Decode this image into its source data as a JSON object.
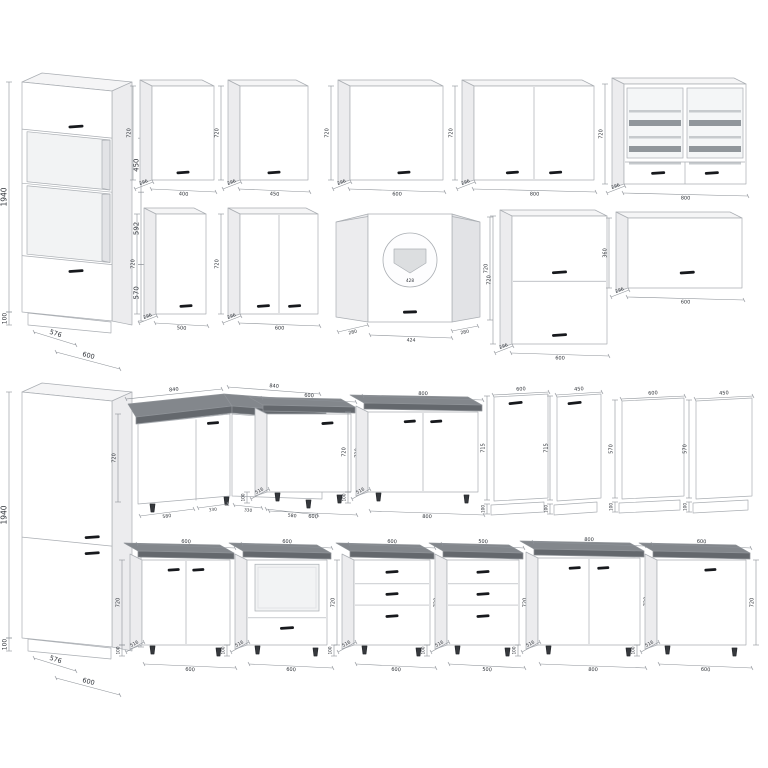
{
  "page": {
    "background": "#ffffff",
    "description": "kitchen cabinet set dimension drawings"
  },
  "colors": {
    "cabinet": "#ffffff",
    "side_shade": "#ececee",
    "side_shade_dark": "#e2e3e6",
    "top_shade": "#f5f5f6",
    "outline": "#aaaeb3",
    "edge_dark": "#8f9398",
    "handle": "#17191d",
    "countertop_top": "#83878c",
    "countertop_edge": "#64686d",
    "dim_line": "#8d9298",
    "dim_text": "#2e3238",
    "niche": "#f2f3f4",
    "glass": "#f4f6f7",
    "stripe_dark": "#90969b",
    "stripe_light": "#c6cacd",
    "plan_fill": "#dcdee0",
    "leg": "#35383c"
  },
  "items": [
    {
      "name": "tall-oven-housing-cabinet",
      "type": "tall-oven",
      "dims": {
        "height_total": "1940",
        "niche_upper": "450",
        "niche_lower": "592",
        "door_lower": "570",
        "plinth": "100",
        "depth": "576",
        "width": "600"
      }
    },
    {
      "name": "wall-cabinet-400",
      "type": "wall",
      "dims": {
        "width": "400",
        "height": "720",
        "depth": "296"
      }
    },
    {
      "name": "wall-cabinet-450",
      "type": "wall",
      "dims": {
        "width": "450",
        "height": "720",
        "depth": "296"
      }
    },
    {
      "name": "wall-cabinet-600",
      "type": "wall",
      "dims": {
        "width": "600",
        "height": "720",
        "depth": "296"
      }
    },
    {
      "name": "wall-cabinet-800-two-door",
      "type": "wall",
      "dims": {
        "width": "800",
        "height": "720",
        "depth": "296"
      }
    },
    {
      "name": "wall-cabinet-800-glass",
      "type": "wall-glass",
      "dims": {
        "width": "800",
        "height": "720",
        "depth": "296"
      }
    },
    {
      "name": "wall-cabinet-500",
      "type": "wall",
      "dims": {
        "width": "500",
        "height": "720",
        "depth": "296"
      }
    },
    {
      "name": "wall-cabinet-600-two-door",
      "type": "wall",
      "dims": {
        "width": "600",
        "height": "720",
        "depth": "296"
      }
    },
    {
      "name": "wall-corner-cabinet",
      "type": "wall-corner",
      "dims": {
        "side_left": "280",
        "front": "424",
        "side_right": "280",
        "height": "720",
        "plan_width": "428"
      }
    },
    {
      "name": "wall-cabinet-flip-two-door-600",
      "type": "wall-flip2",
      "dims": {
        "width": "600",
        "height": "720",
        "depth": "296"
      }
    },
    {
      "name": "wall-cabinet-horizontal-600",
      "type": "wall-flip1",
      "dims": {
        "width": "600",
        "height": "360",
        "depth": "296"
      }
    },
    {
      "name": "tall-fridge-housing-cabinet",
      "type": "tall-fridge",
      "dims": {
        "height_total": "1940",
        "lower_door": "720",
        "plinth": "100",
        "depth": "576",
        "width": "600"
      }
    },
    {
      "name": "base-corner-cabinet-840",
      "type": "base-corner",
      "dims": {
        "top_left": "840",
        "top_right": "840",
        "height": "720",
        "front_left": "580",
        "inner_left": "330",
        "inner_right": "330",
        "front_right": "580"
      }
    },
    {
      "name": "base-cabinet-600",
      "type": "base",
      "dims": {
        "width": "600",
        "height": "720",
        "depth": "516",
        "plinth": "100"
      }
    },
    {
      "name": "base-cabinet-800-two-door",
      "type": "base",
      "dims": {
        "width": "800",
        "height": "720",
        "depth": "516",
        "plinth": "100"
      }
    },
    {
      "name": "dishwasher-front-panel-600",
      "type": "panel",
      "dims": {
        "width": "600",
        "height": "715",
        "plinth": "100"
      }
    },
    {
      "name": "dishwasher-front-panel-450",
      "type": "panel",
      "dims": {
        "width": "450",
        "height": "715",
        "plinth": "100"
      }
    },
    {
      "name": "cover-panel-600",
      "type": "panel",
      "dims": {
        "width": "600",
        "height": "570",
        "plinth": "100"
      }
    },
    {
      "name": "cover-panel-450",
      "type": "panel",
      "dims": {
        "width": "450",
        "height": "570",
        "plinth": "100"
      }
    },
    {
      "name": "base-sink-cabinet-600-two-door",
      "type": "base",
      "dims": {
        "width": "600",
        "height": "720",
        "depth": "516",
        "plinth": "100"
      }
    },
    {
      "name": "base-oven-housing-cabinet-600",
      "type": "base-oven",
      "dims": {
        "width": "600",
        "height": "720",
        "depth": "516",
        "plinth": "100"
      }
    },
    {
      "name": "base-drawer-cabinet-600",
      "type": "base-drawers",
      "dims": {
        "width": "600",
        "height": "720",
        "depth": "516",
        "plinth": "100"
      }
    },
    {
      "name": "base-drawer-cabinet-500",
      "type": "base-drawers",
      "dims": {
        "width": "500",
        "height": "720",
        "depth": "516",
        "plinth": "100"
      }
    },
    {
      "name": "base-cabinet-800-two-door-lower",
      "type": "base",
      "dims": {
        "width": "800",
        "height": "720",
        "depth": "516",
        "plinth": "100"
      }
    },
    {
      "name": "base-cabinet-600-single-door-lower",
      "type": "base",
      "dims": {
        "width": "600",
        "height": "720",
        "depth": "516",
        "plinth": "100"
      }
    }
  ]
}
